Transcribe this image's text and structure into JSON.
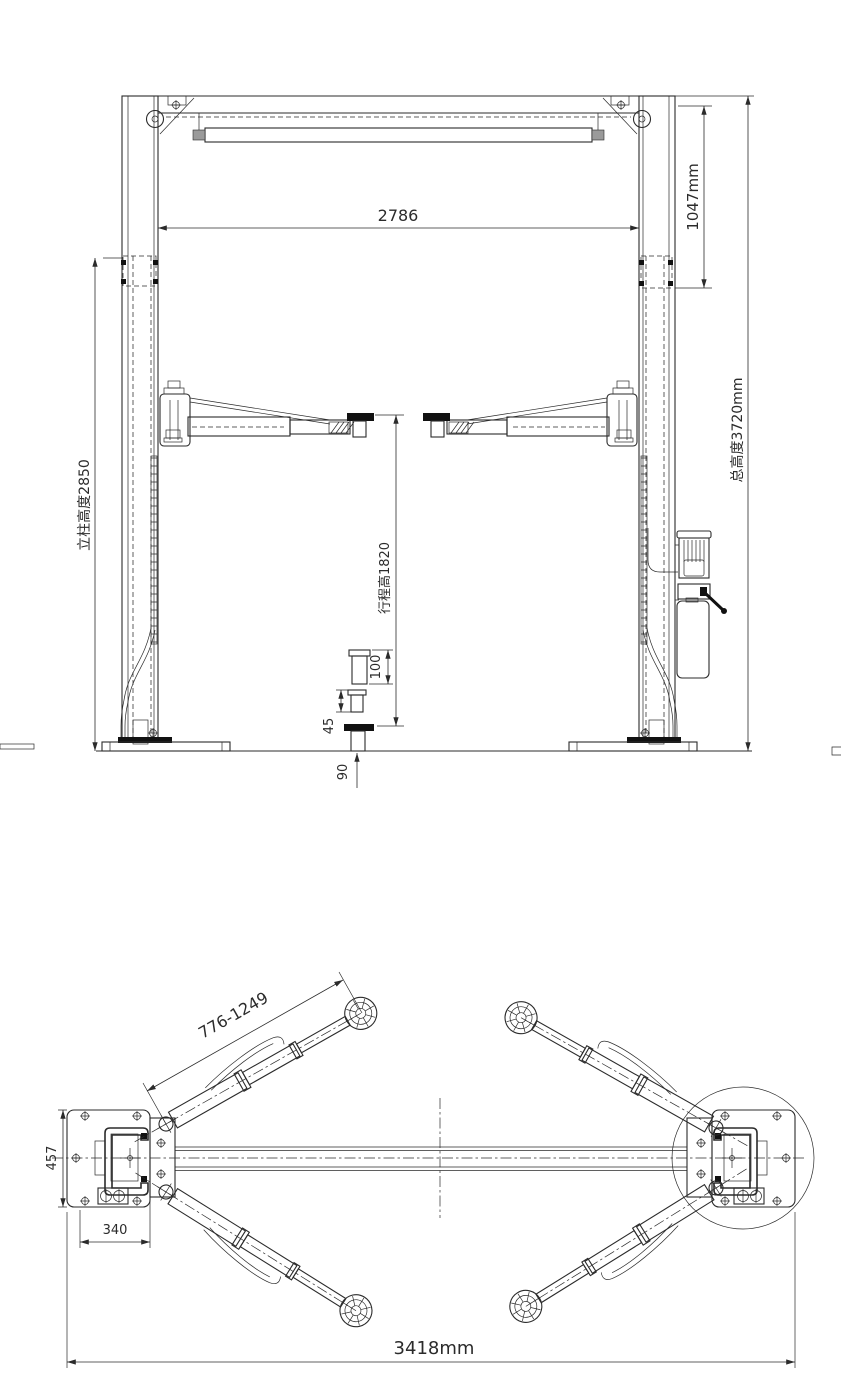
{
  "drawing": {
    "type": "two-post-car-lift engineering drawing, front elevation and plan view",
    "colors": {
      "line": "#2b2b2b",
      "background": "#ffffff",
      "pad_fill": "#111111",
      "end_cap_gray": "#9a9a9a"
    }
  },
  "front_view": {
    "dims": {
      "span_between_columns": "2786",
      "top_clearance": "1047mm",
      "column_height": "立柱高度2850",
      "overall_height": "总高度3720mm",
      "stroke_height": "行程高1820",
      "adapter_tall": "100",
      "adapter_mid": "45",
      "pad_min_height": "90"
    }
  },
  "plan_view": {
    "dims": {
      "arm_reach_range": "776-1249",
      "base_plate_depth": "457",
      "base_plate_width": "340",
      "overall_width": "3418mm"
    }
  }
}
